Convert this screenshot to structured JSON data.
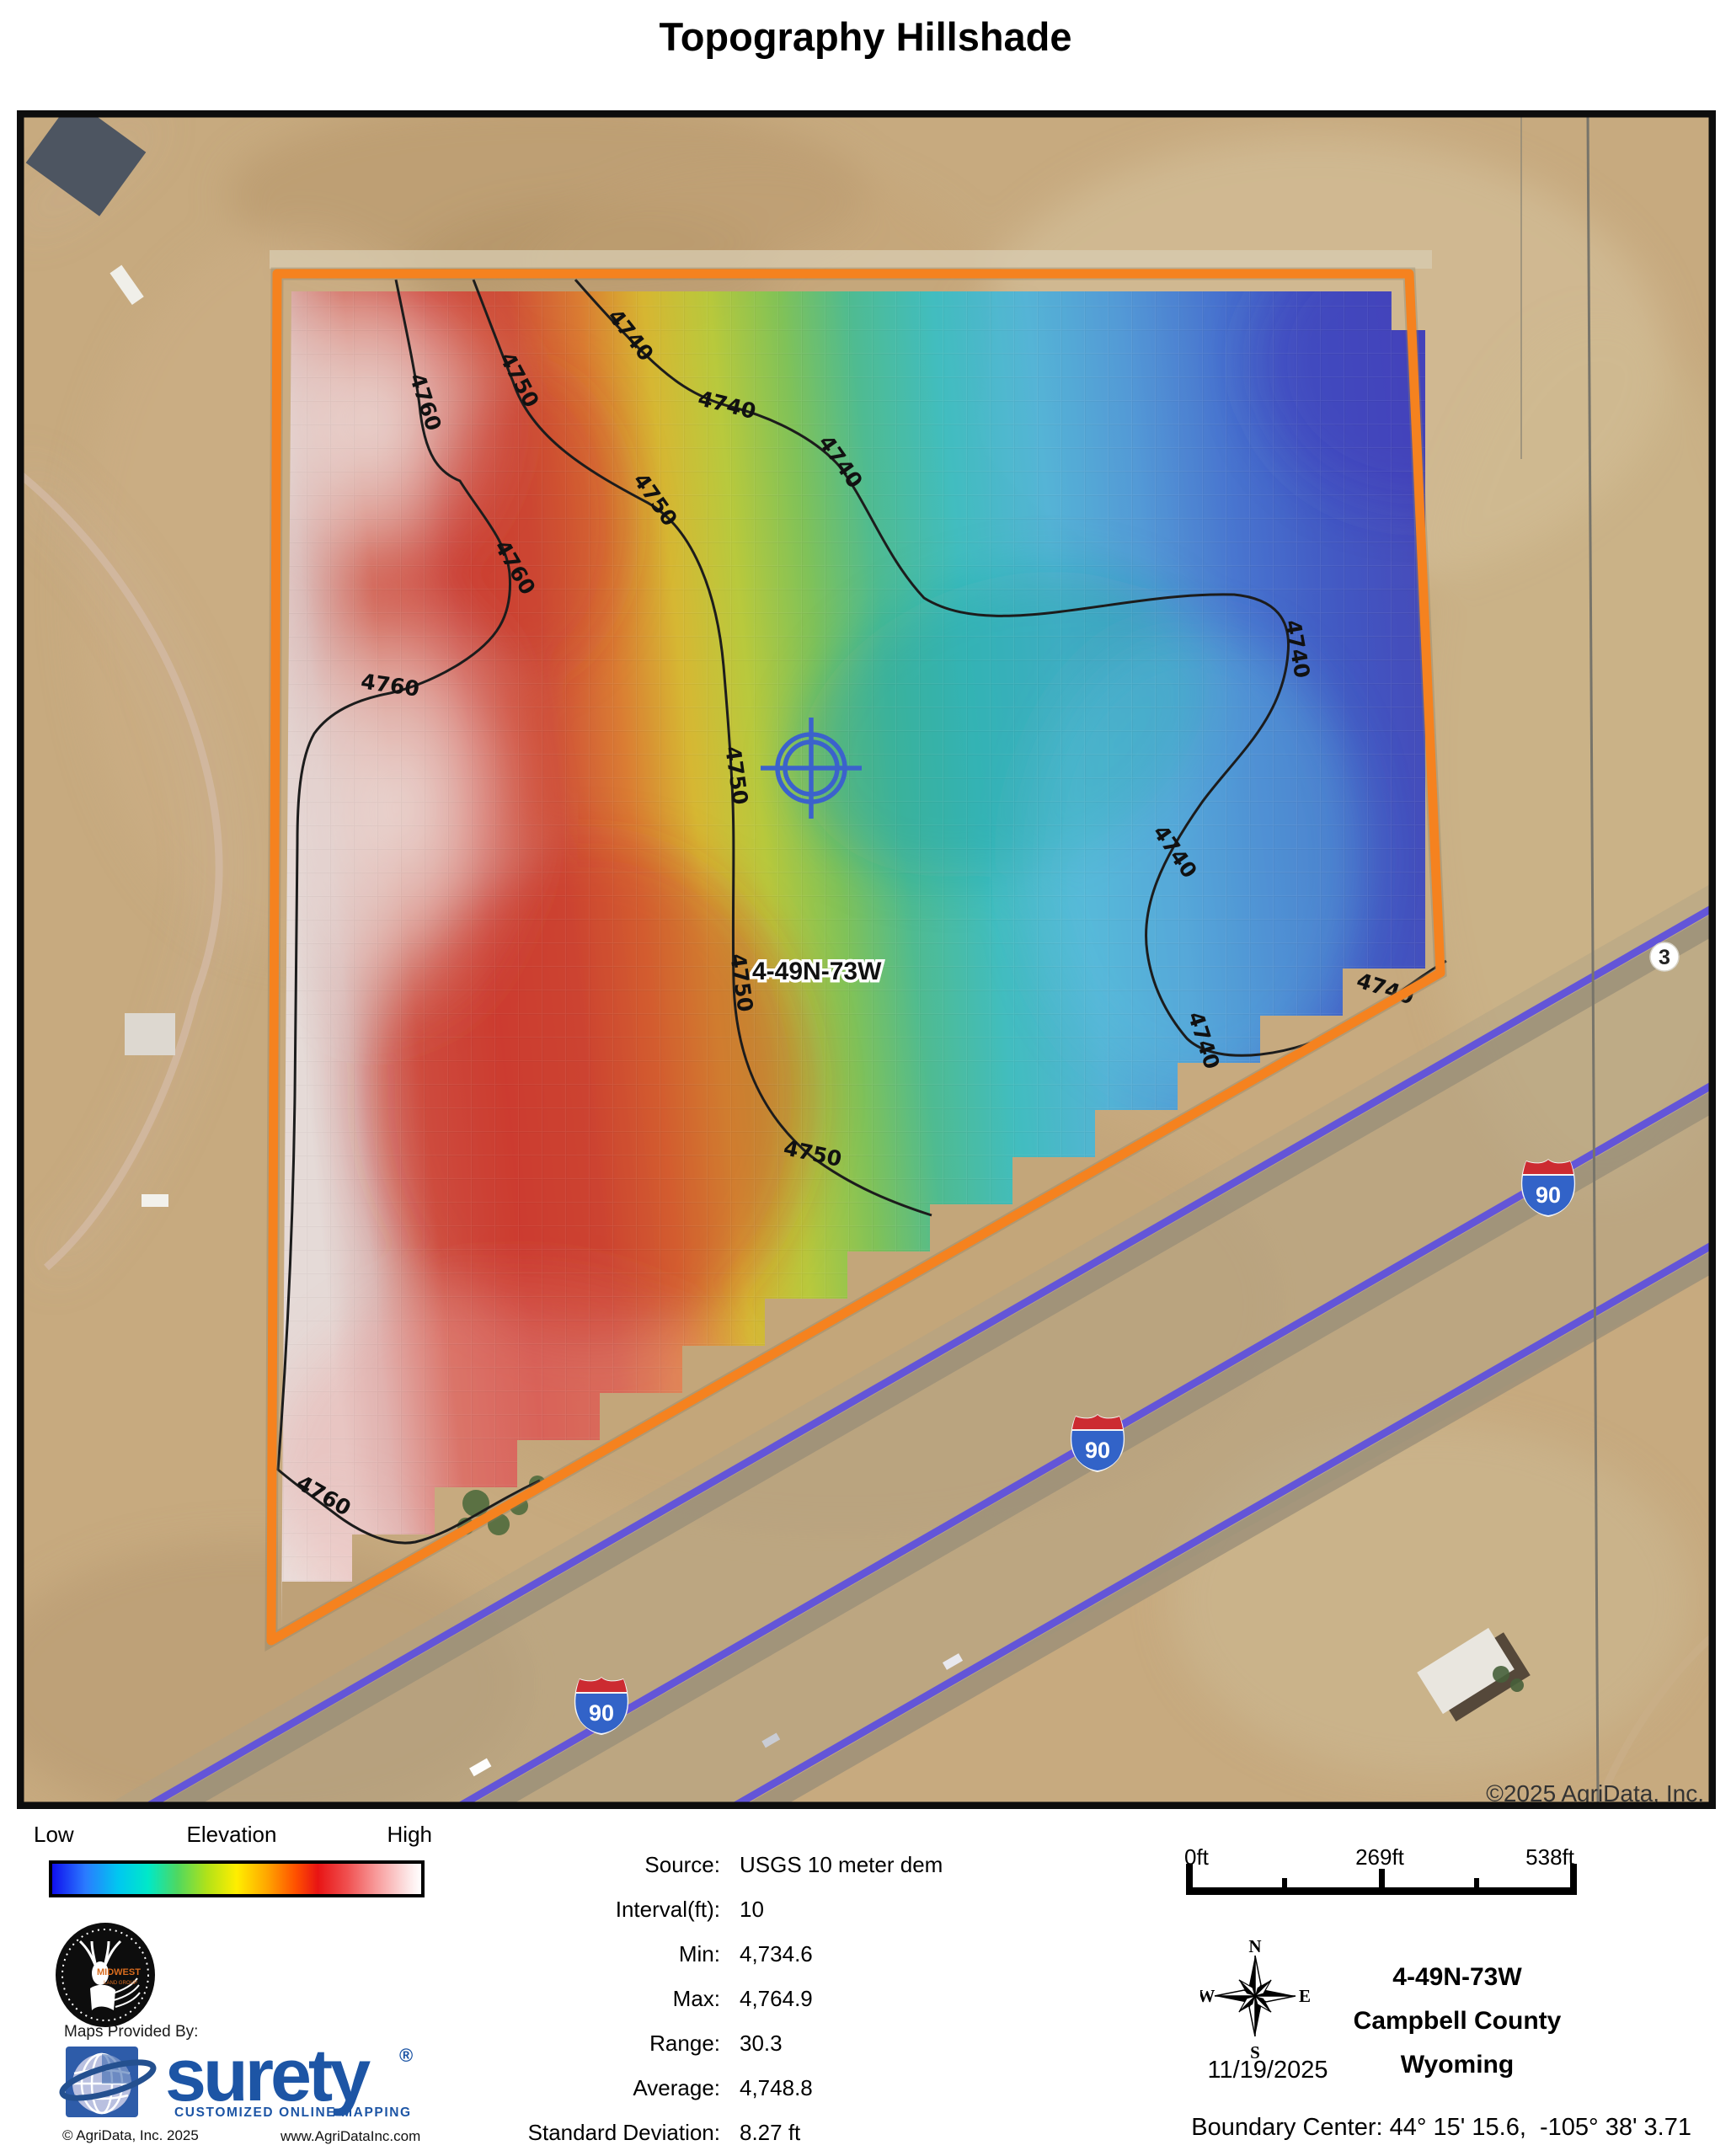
{
  "title": "Topography Hillshade",
  "map": {
    "parcel_label": "4-49N-73W",
    "interstate_label": "90",
    "section_label": "3",
    "copyright": "©2025 AgriData, Inc.",
    "contour_labels": [
      "4740",
      "4740",
      "4740",
      "4740",
      "4740",
      "4740",
      "4740",
      "4750",
      "4750",
      "4750",
      "4750",
      "4750",
      "4760",
      "4760",
      "4760",
      "4760"
    ],
    "boundary_color": "#f5821f",
    "highway_color": "#6355d8"
  },
  "legend": {
    "low": "Low",
    "title": "Elevation",
    "high": "High",
    "ramp": [
      "#1010ee",
      "#00c8f0",
      "#4fd860",
      "#ffee00",
      "#ff5000",
      "#e81414",
      "#f89c9c",
      "#ffffff"
    ]
  },
  "stats": {
    "rows": [
      {
        "label": "Source:",
        "value": "USGS 10 meter dem"
      },
      {
        "label": "Interval(ft):",
        "value": "10"
      },
      {
        "label": "Min:",
        "value": "4,734.6"
      },
      {
        "label": "Max:",
        "value": "4,764.9"
      },
      {
        "label": "Range:",
        "value": "30.3"
      },
      {
        "label": "Average:",
        "value": "4,748.8"
      },
      {
        "label": "Standard Deviation:",
        "value": "8.27 ft"
      }
    ]
  },
  "scalebar": {
    "start": "0ft",
    "middle": "269ft",
    "end": "538ft"
  },
  "compass": {
    "n": "N",
    "e": "E",
    "s": "S",
    "w": "W"
  },
  "date": "11/19/2025",
  "location": {
    "trs": "4-49N-73W",
    "county": "Campbell County",
    "state": "Wyoming"
  },
  "boundary_center": "Boundary Center: 44° 15' 15.6,  -105° 38' 3.71",
  "provider": {
    "maps_provided_by": "Maps Provided By:",
    "brand": "surety",
    "reg": "®",
    "tagline": "CUSTOMIZED ONLINE MAPPING",
    "copyright": "© AgriData, Inc. 2025",
    "website": "www.AgriDataInc.com",
    "midwest": "MIDWEST",
    "midwest_sub": "LAND GROUP"
  }
}
